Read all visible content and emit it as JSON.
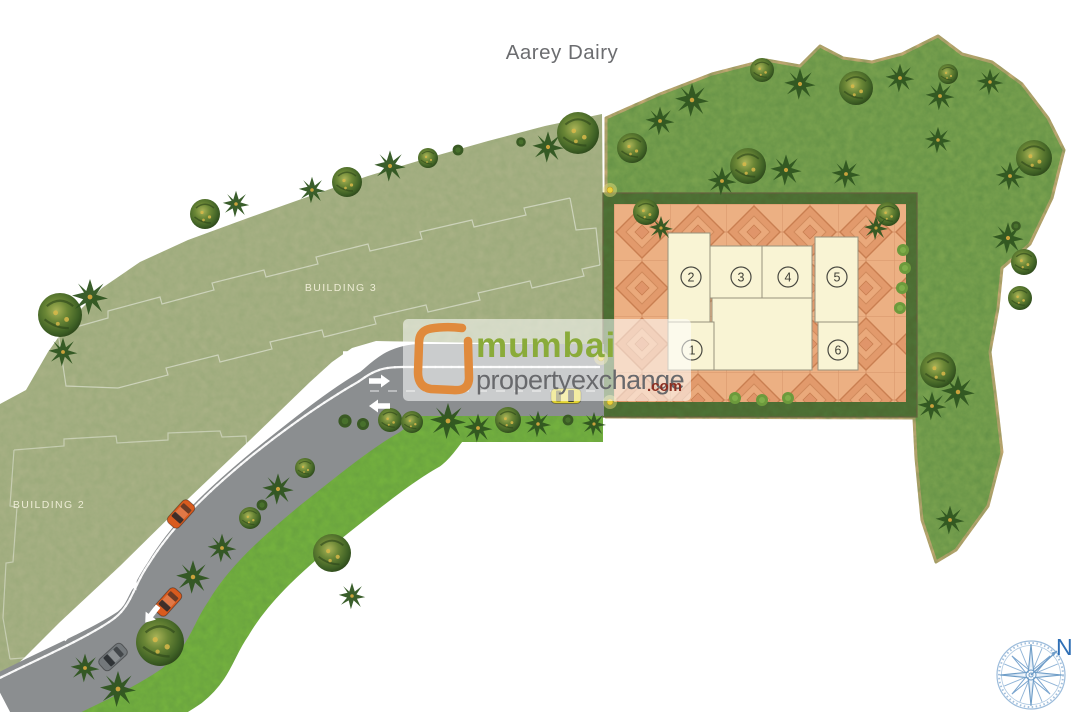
{
  "title": {
    "text": "Aarey Dairy"
  },
  "parcels": {
    "building3_label": "BUILDING 3",
    "building2_label": "BUILDING 2"
  },
  "units": [
    {
      "label": "1"
    },
    {
      "label": "2"
    },
    {
      "label": "3"
    },
    {
      "label": "4"
    },
    {
      "label": "5"
    },
    {
      "label": "6"
    }
  ],
  "logo": {
    "word1": "mumbai",
    "word2": "propertyexchange",
    "suffix": ".com"
  },
  "compass": {
    "north_label": "N"
  },
  "colors": {
    "background": "#ffffff",
    "parcel_olive": "#a8b185",
    "lawn_green": "#7aa24f",
    "roadside_green": "#74b13f",
    "road_gray": "#8b8e90",
    "road_marking_white": "#fdfdfd",
    "median_dot_green": "#1c3110",
    "plaza_tile_salmon": "#ecb083",
    "hedge_dark_green": "#4d6a31",
    "building_cream": "#f9f4d4",
    "boundary_tan": "#c7a975",
    "logo_orange": "#e08a3c",
    "logo_green": "#8aab3a",
    "logo_gray": "#68696c",
    "logo_red": "#8c2f22",
    "compass_blue": "#7aa5cf",
    "car_orange": "#d95b1e",
    "car_yellow": "#e3d531",
    "car_gray": "#73787b"
  },
  "trees": [
    [
      "r",
      60,
      315,
      2.2
    ],
    [
      "p",
      90,
      297,
      1.5
    ],
    [
      "p",
      63,
      352,
      1.2
    ],
    [
      "r",
      205,
      214,
      1.5
    ],
    [
      "p",
      236,
      204,
      1.1
    ],
    [
      "p",
      312,
      190,
      1.1
    ],
    [
      "r",
      347,
      182,
      1.5
    ],
    [
      "p",
      390,
      166,
      1.3
    ],
    [
      "r",
      428,
      158,
      1.0
    ],
    [
      "b",
      458,
      150,
      0.9
    ],
    [
      "p",
      548,
      147,
      1.3
    ],
    [
      "r",
      578,
      133,
      2.1
    ],
    [
      "b",
      521,
      142,
      0.8
    ],
    [
      "r",
      160,
      642,
      2.4
    ],
    [
      "p",
      118,
      689,
      1.5
    ],
    [
      "p",
      85,
      668,
      1.2
    ],
    [
      "p",
      193,
      577,
      1.4
    ],
    [
      "p",
      222,
      548,
      1.2
    ],
    [
      "r",
      250,
      518,
      1.1
    ],
    [
      "p",
      278,
      489,
      1.3
    ],
    [
      "r",
      305,
      468,
      1.0
    ],
    [
      "r",
      332,
      553,
      1.9
    ],
    [
      "b",
      262,
      505,
      0.9
    ],
    [
      "p",
      352,
      596,
      1.1
    ],
    [
      "b",
      345,
      421,
      1.1
    ],
    [
      "b",
      363,
      424,
      1.0
    ],
    [
      "r",
      390,
      420,
      1.2
    ],
    [
      "r",
      412,
      422,
      1.1
    ],
    [
      "p",
      448,
      421,
      1.5
    ],
    [
      "p",
      478,
      428,
      1.2
    ],
    [
      "r",
      508,
      420,
      1.3
    ],
    [
      "p",
      538,
      424,
      1.1
    ],
    [
      "b",
      568,
      420,
      0.9
    ],
    [
      "p",
      594,
      424,
      1.0
    ],
    [
      "r",
      632,
      148,
      1.5
    ],
    [
      "p",
      660,
      121,
      1.2
    ],
    [
      "p",
      692,
      100,
      1.4
    ],
    [
      "r",
      748,
      166,
      1.8
    ],
    [
      "p",
      722,
      181,
      1.2
    ],
    [
      "r",
      762,
      70,
      1.2
    ],
    [
      "p",
      800,
      84,
      1.3
    ],
    [
      "r",
      856,
      88,
      1.7
    ],
    [
      "p",
      900,
      78,
      1.2
    ],
    [
      "p",
      940,
      96,
      1.2
    ],
    [
      "r",
      948,
      74,
      1.0
    ],
    [
      "p",
      990,
      82,
      1.1
    ],
    [
      "r",
      1034,
      158,
      1.8
    ],
    [
      "p",
      1010,
      176,
      1.2
    ],
    [
      "r",
      1024,
      262,
      1.3
    ],
    [
      "p",
      938,
      140,
      1.1
    ],
    [
      "p",
      1008,
      238,
      1.3
    ],
    [
      "b",
      1016,
      226,
      0.8
    ],
    [
      "r",
      1020,
      298,
      1.2
    ],
    [
      "r",
      938,
      370,
      1.8
    ],
    [
      "p",
      958,
      392,
      1.4
    ],
    [
      "p",
      932,
      406,
      1.2
    ],
    [
      "p",
      950,
      520,
      1.2
    ],
    [
      "p",
      786,
      170,
      1.3
    ],
    [
      "p",
      846,
      174,
      1.2
    ],
    [
      "r",
      646,
      212,
      1.3
    ],
    [
      "p",
      661,
      228,
      1.0
    ],
    [
      "r",
      888,
      214,
      1.2
    ],
    [
      "p",
      876,
      228,
      1.0
    ],
    [
      "lb",
      903,
      250,
      1.0
    ],
    [
      "lb",
      905,
      268,
      1.0
    ],
    [
      "lb",
      902,
      288,
      1.0
    ],
    [
      "lb",
      900,
      308,
      1.0
    ],
    [
      "lb",
      735,
      398,
      1.0
    ],
    [
      "lb",
      762,
      400,
      1.0
    ],
    [
      "lb",
      788,
      398,
      1.0
    ]
  ],
  "cars": [
    {
      "c": "#d95b1e",
      "x": 181,
      "y": 514,
      "a": -48
    },
    {
      "c": "#d95b1e",
      "x": 168,
      "y": 602,
      "a": -48
    },
    {
      "c": "#73787b",
      "x": 113,
      "y": 657,
      "a": -42
    },
    {
      "c": "#e3d531",
      "x": 566,
      "y": 396,
      "a": 180
    }
  ],
  "arrows": [
    {
      "x": 353,
      "y": 354,
      "a": 0
    },
    {
      "x": 379,
      "y": 381,
      "a": 0
    },
    {
      "x": 380,
      "y": 406,
      "a": 180
    },
    {
      "x": 130,
      "y": 588,
      "a": -52
    },
    {
      "x": 152,
      "y": 614,
      "a": 128
    },
    {
      "x": 70,
      "y": 632,
      "a": -48
    }
  ],
  "lamps": [
    {
      "x": 610,
      "y": 190
    },
    {
      "x": 610,
      "y": 402
    },
    {
      "x": 601,
      "y": 358
    }
  ]
}
